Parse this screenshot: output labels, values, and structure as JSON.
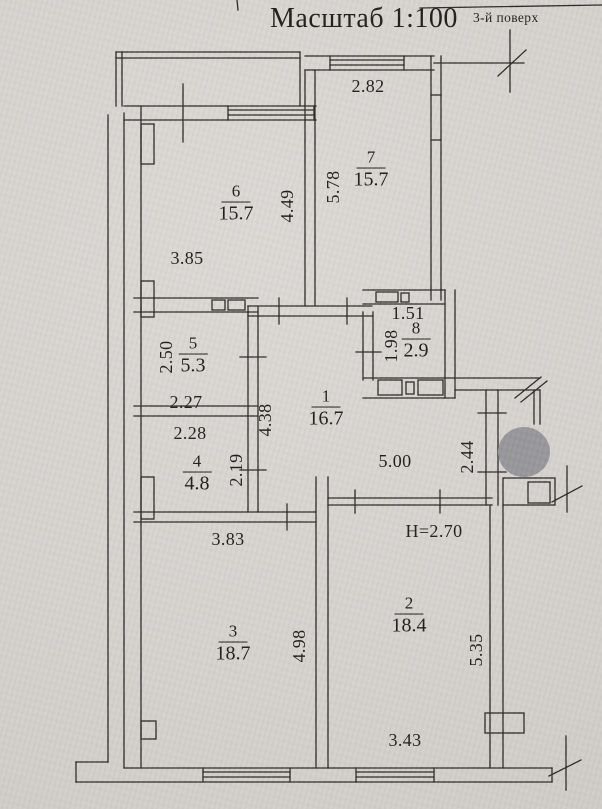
{
  "header": {
    "scale_label": "Масштаб 1:100",
    "floor_label": "3-й поверх"
  },
  "plan": {
    "ceiling_height": "Н=2.70",
    "rooms": [
      {
        "number": "1",
        "area": "16.7"
      },
      {
        "number": "2",
        "area": "18.4"
      },
      {
        "number": "3",
        "area": "18.7"
      },
      {
        "number": "4",
        "area": "4.8"
      },
      {
        "number": "5",
        "area": "5.3"
      },
      {
        "number": "6",
        "area": "15.7"
      },
      {
        "number": "7",
        "area": "15.7"
      },
      {
        "number": "8",
        "area": "2.9"
      }
    ],
    "dimensions": {
      "room7_width_top": "2.82",
      "room6_width_bottom": "3.85",
      "room6_depth_right": "4.49",
      "room7_depth_left": "5.78",
      "room8_width_top": "1.51",
      "room8_depth_left": "1.98",
      "room5_depth_left": "2.50",
      "room5_width_bottom": "2.27",
      "room4_width_top": "2.28",
      "hall_depth_left": "4.38",
      "room4_depth_right": "2.19",
      "hall_width": "5.00",
      "entry_depth_right": "2.44",
      "room3_width_top": "3.83",
      "room3_depth_right": "4.98",
      "room2_depth_right": "5.35",
      "room2_width_bottom": "3.43"
    }
  }
}
